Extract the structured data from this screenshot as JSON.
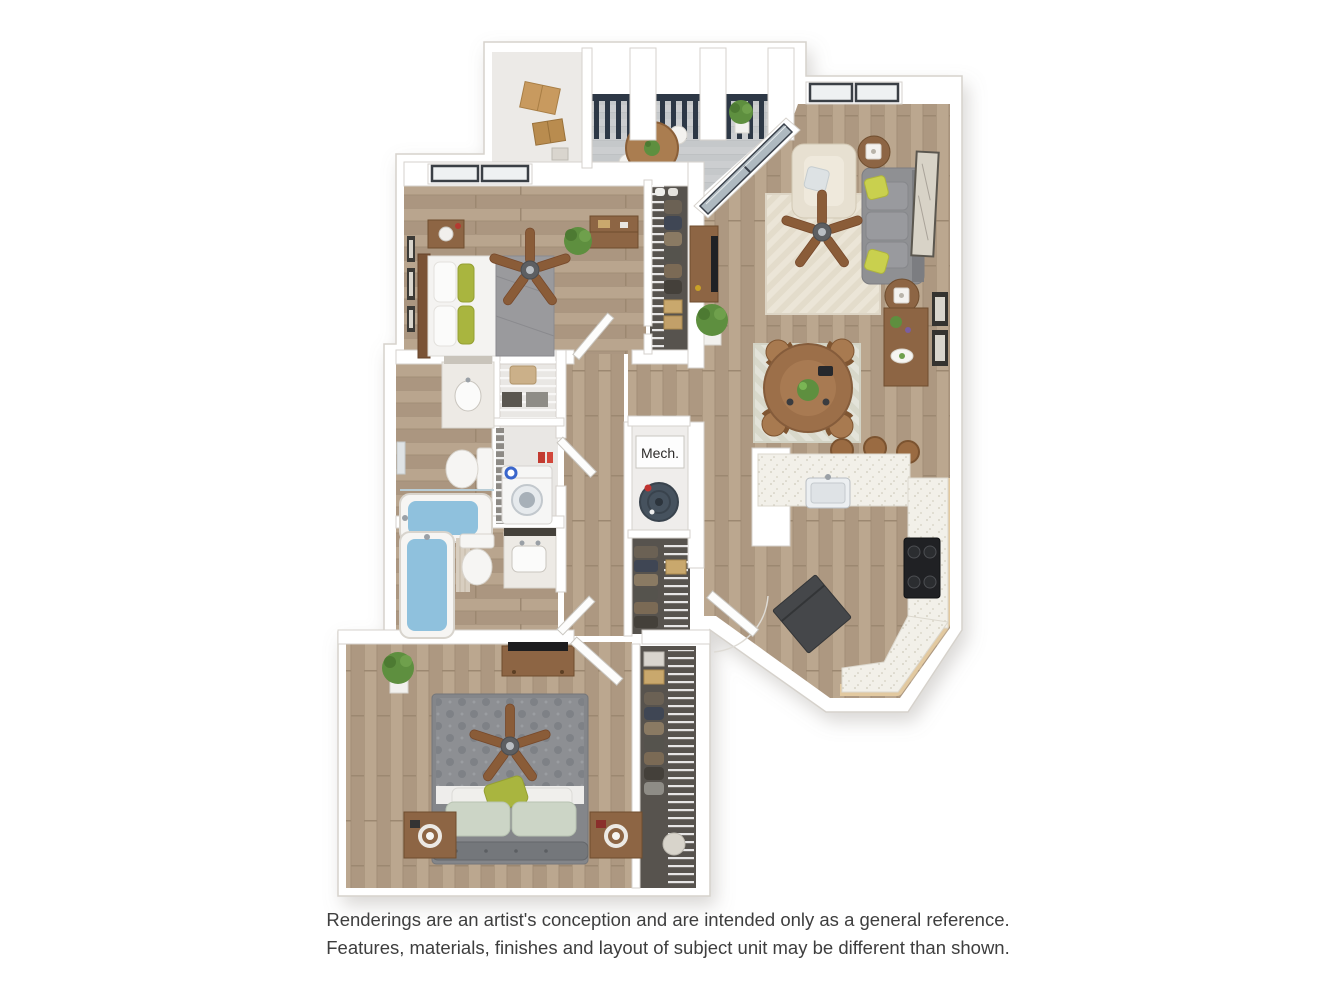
{
  "canvas": {
    "width": 1336,
    "height": 1002,
    "background": "#ffffff"
  },
  "floorplan": {
    "type": "3d-rendered-apartment-floor-plan",
    "mech_closet_label": "Mech.",
    "palette": {
      "wall_fill": "#ffffff",
      "wall_line": "#d6d2cc",
      "wood_floor": "#b5a18a",
      "wood_floor_dark": "#9c8871",
      "deck_gray": "#ccced0",
      "railing_navy": "#2d3846",
      "counter_speckle": "#f2f0e9",
      "cabinet_wood": "#e2c9a0",
      "sofa_gray": "#8f9093",
      "bed_gray": "#8d8f93",
      "accent_green": "#a9b53f",
      "plant_green": "#5e8f3f",
      "furniture_wood": "#8d6544",
      "water_blue": "#8fc1dd",
      "appliance_black": "#202124",
      "fridge_gray": "#45474a",
      "washer_dial_blue": "#3a66cc",
      "closet_floor": "#57534e",
      "rug_cream": "#ebe5d7",
      "rug_sage": "#e3e3d9"
    }
  },
  "disclaimer": {
    "line1": "Renderings are an artist's conception and are intended only as a general reference.",
    "line2": "Features, materials, finishes and layout of subject unit may be different than shown."
  }
}
